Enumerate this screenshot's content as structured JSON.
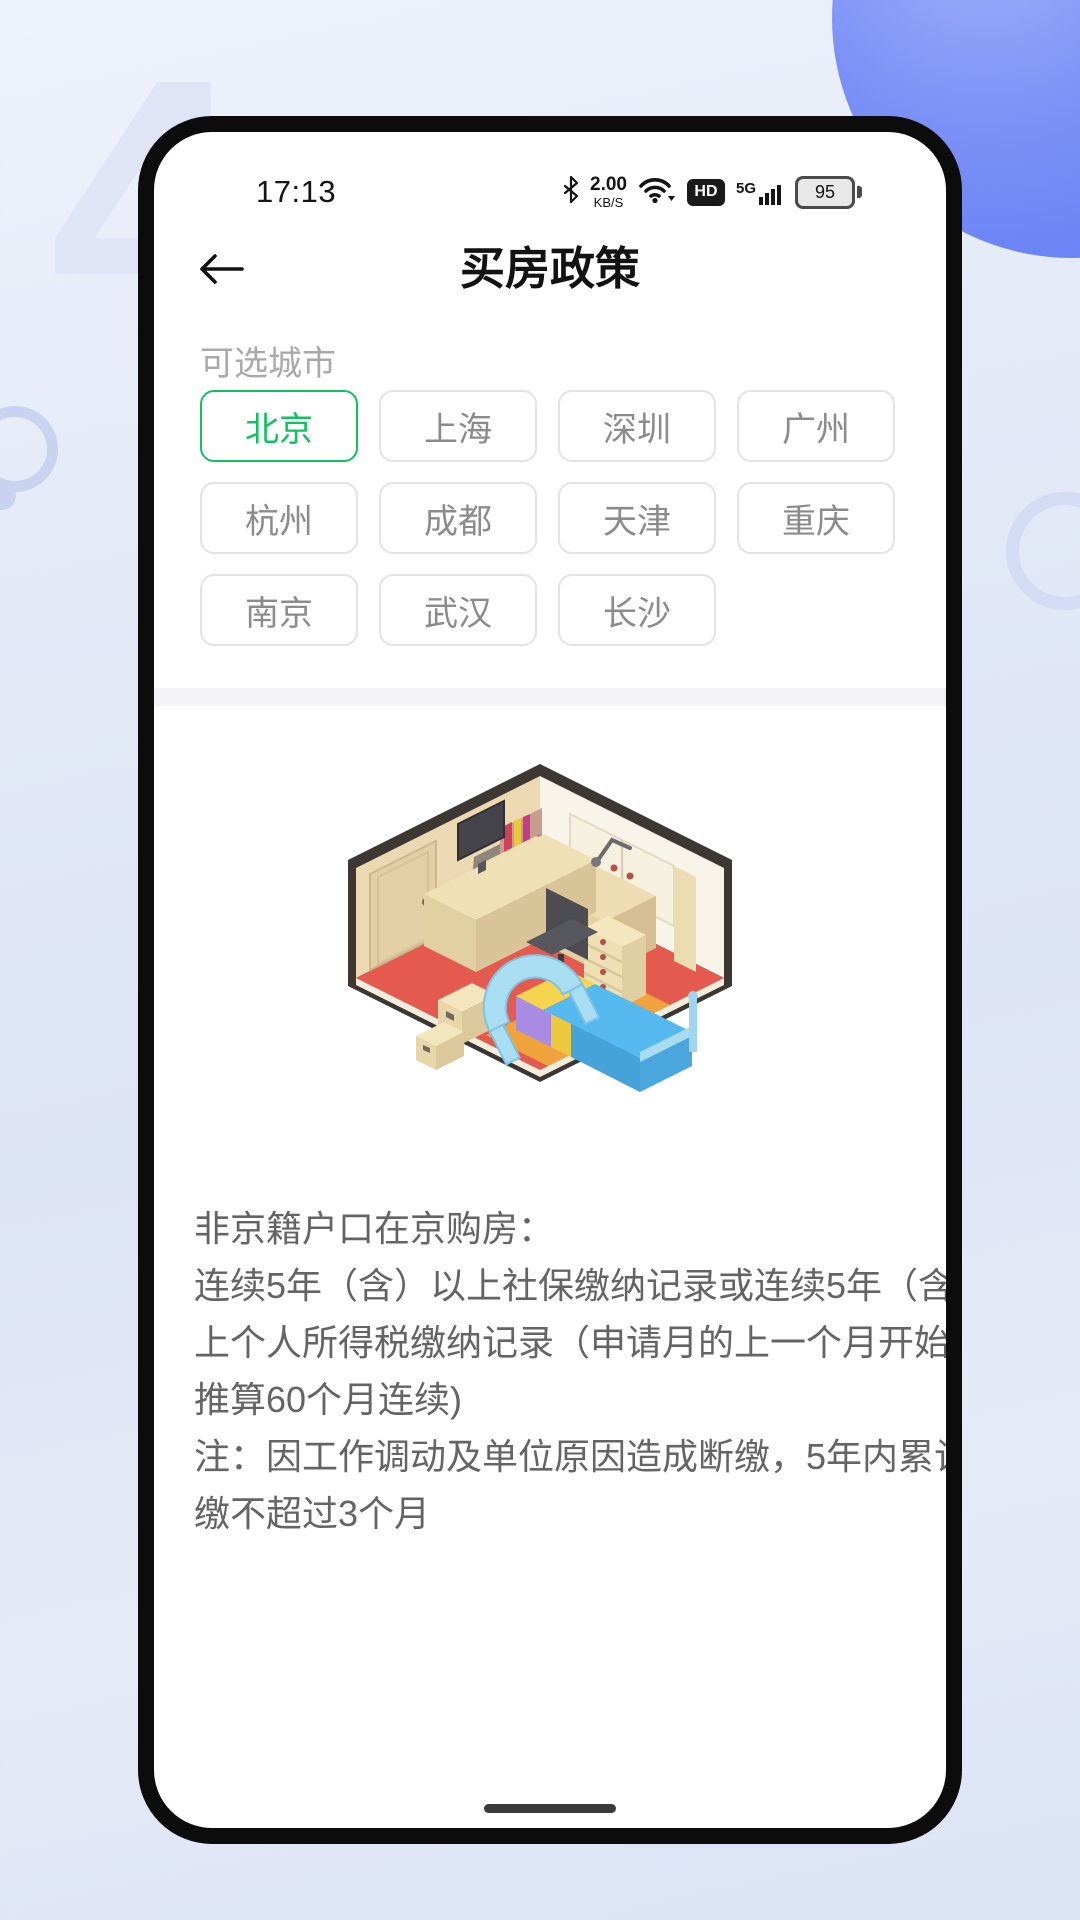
{
  "status_bar": {
    "time": "17:13",
    "network_speed_value": "2.00",
    "network_speed_unit": "KB/S",
    "hd_label": "HD",
    "network_type": "5G",
    "battery_percent": "95"
  },
  "header": {
    "title": "买房政策"
  },
  "city_section": {
    "label": "可选城市",
    "cities": [
      {
        "label": "北京",
        "selected": true
      },
      {
        "label": "上海",
        "selected": false
      },
      {
        "label": "深圳",
        "selected": false
      },
      {
        "label": "广州",
        "selected": false
      },
      {
        "label": "杭州",
        "selected": false
      },
      {
        "label": "成都",
        "selected": false
      },
      {
        "label": "天津",
        "selected": false
      },
      {
        "label": "重庆",
        "selected": false
      },
      {
        "label": "南京",
        "selected": false
      },
      {
        "label": "武汉",
        "selected": false
      },
      {
        "label": "长沙",
        "selected": false
      }
    ]
  },
  "illustration": {
    "name": "isometric-bedroom-illustration"
  },
  "policy": {
    "lines": [
      "非京籍户口在京购房：",
      "连续5年（含）以上社保缴纳记录或连续5年（含）以",
      "上个人所得税缴纳记录（申请月的上一个月开始往前",
      "推算60个月连续)",
      "注：因工作调动及单位原因造成断缴，5年内累计补",
      "缴不超过3个月"
    ]
  },
  "icons": {
    "back": "arrow-left-icon",
    "bluetooth": "bluetooth-icon",
    "wifi": "wifi-icon",
    "hd": "hd-badge-icon",
    "signal": "signal-bars-icon",
    "battery": "battery-icon",
    "home": "home-indicator"
  },
  "colors": {
    "accent_green": "#0fc25f",
    "chip_border": "#e3e3e3",
    "chip_text": "#8b8b8b",
    "body_text": "#646464",
    "decor_blue": "#5d78f4"
  }
}
